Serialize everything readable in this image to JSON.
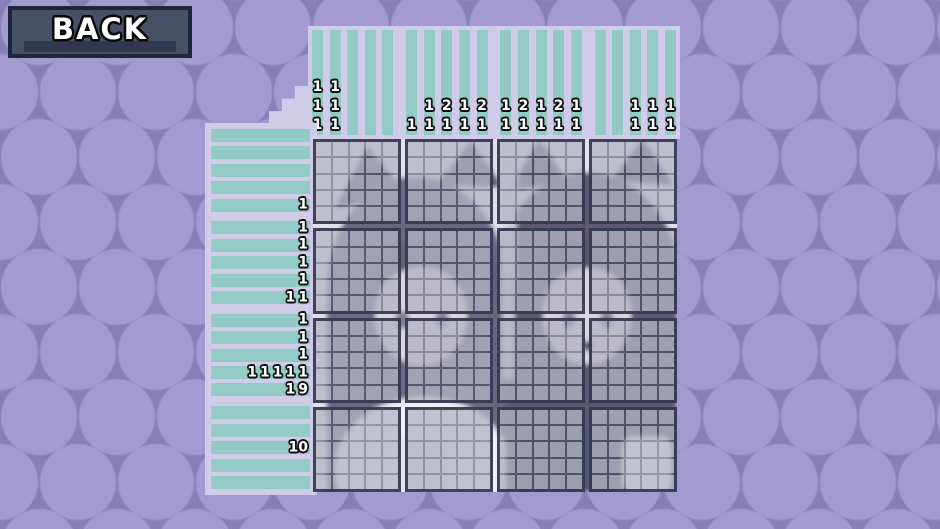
{
  "back_button": {
    "label": "BACK"
  },
  "puzzle": {
    "rows": 20,
    "cols": 20,
    "block_size": 5,
    "column_clues": [
      [
        1,
        1,
        1
      ],
      [
        1,
        1,
        1
      ],
      [],
      [],
      [],
      [
        1
      ],
      [
        1,
        1
      ],
      [
        2,
        1
      ],
      [
        1,
        1
      ],
      [
        2,
        1
      ],
      [
        1,
        1
      ],
      [
        2,
        1
      ],
      [
        1,
        1
      ],
      [
        2,
        1
      ],
      [
        1,
        1
      ],
      [],
      [],
      [
        1,
        1
      ],
      [
        1,
        1
      ],
      [
        1,
        1
      ]
    ],
    "row_clues": [
      [],
      [],
      [],
      [],
      [
        1
      ],
      [
        1
      ],
      [
        1
      ],
      [
        1
      ],
      [
        1
      ],
      [
        1,
        1
      ],
      [
        1
      ],
      [
        1
      ],
      [
        1
      ],
      [
        1,
        1,
        1,
        1,
        1
      ],
      [
        1,
        9
      ],
      [],
      [],
      [
        10
      ],
      [],
      []
    ],
    "background_image": "two-cat-eared-anime-characters-faded"
  },
  "colors": {
    "background_base": "#8780b8",
    "background_dot": "#a29ad1",
    "clue_panel": "#d1cbea",
    "clue_strip": "#92cbc5",
    "clue_text": "#ffffff",
    "clue_text_outline": "#101010",
    "grid_block_border": "#343a52",
    "grid_line": "#484e68",
    "cell_overlay": "#eeecf7",
    "button_frame": "#1f2539",
    "button_face": "#475067",
    "button_shadow": "#313852"
  }
}
